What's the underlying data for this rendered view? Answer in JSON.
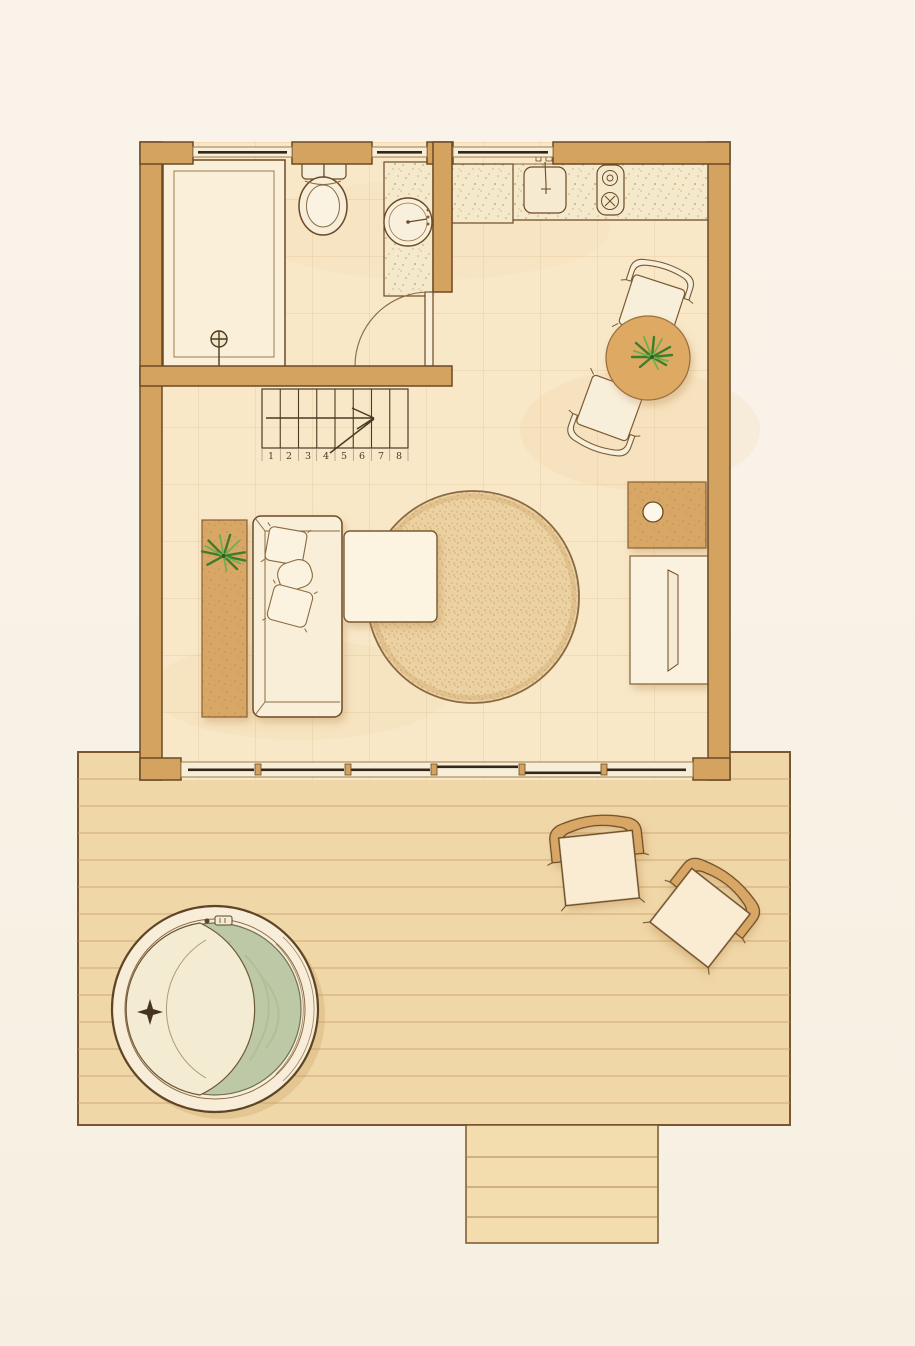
{
  "document": {
    "type": "architectural floor plan, top-down view: small cabin with outdoor deck",
    "style": "hand-drawn watercolor, sepia and tan palette"
  },
  "house": {
    "bathroom": {
      "fixtures": [
        "shower",
        "toilet",
        "vanity-sink",
        "swing-door"
      ]
    },
    "kitchen": {
      "fixtures": [
        "speckled-counter",
        "tall-unit",
        "sink",
        "two-burner-cooktop"
      ]
    },
    "dining": {
      "furniture": [
        "round-table",
        "potted-plant",
        "chair",
        "chair"
      ]
    },
    "living": {
      "furniture": [
        "console-shelf",
        "potted-plant",
        "sofa",
        "pillow",
        "pillow",
        "pillow",
        "coffee-table",
        "round-rug",
        "side-cabinet",
        "lamp",
        "tv-console",
        "tv"
      ]
    },
    "stairs": {
      "treads": [
        "1",
        "2",
        "3",
        "4",
        "5",
        "6",
        "7",
        "8"
      ],
      "direction_arrow": "up"
    },
    "openings": [
      "window",
      "window",
      "window",
      "sliding-glass-wall"
    ]
  },
  "deck": {
    "features": [
      "hot-tub",
      "crescent-bench",
      "jet-star",
      "control-panel",
      "lounge-chair",
      "lounge-chair",
      "entry-steps"
    ]
  },
  "colors": {
    "paper": "#f9f4ea",
    "wall": "#d4a360",
    "wall_outline": "#6b4a26",
    "floor": "#f8e8c8",
    "deck": "#f0d7a8",
    "furniture_cream": "#f9efd9",
    "furniture_tan": "#d9a765",
    "rug": "#ecd2a2",
    "hot_tub_water": "#bdc9a6",
    "plant": "#4e8f37",
    "glass": "#33271a"
  }
}
